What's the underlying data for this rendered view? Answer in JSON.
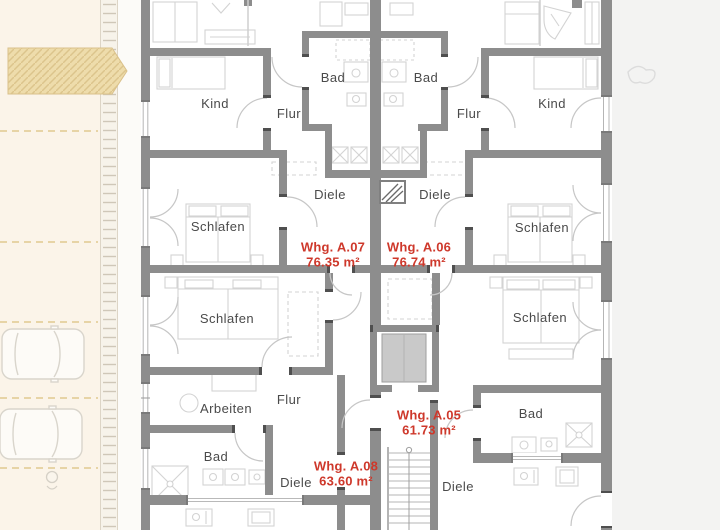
{
  "rooms": [
    {
      "id": "kind-left",
      "label": "Kind"
    },
    {
      "id": "flur-upper-left",
      "label": "Flur"
    },
    {
      "id": "bad-upper-left",
      "label": "Bad"
    },
    {
      "id": "bad-upper-right",
      "label": "Bad"
    },
    {
      "id": "flur-upper-right",
      "label": "Flur"
    },
    {
      "id": "kind-right",
      "label": "Kind"
    },
    {
      "id": "diele-upper-left",
      "label": "Diele"
    },
    {
      "id": "diele-upper-right",
      "label": "Diele"
    },
    {
      "id": "schlafen-upper-left",
      "label": "Schlafen"
    },
    {
      "id": "schlafen-upper-right",
      "label": "Schlafen"
    },
    {
      "id": "schlafen-lower-left",
      "label": "Schlafen"
    },
    {
      "id": "schlafen-lower-right",
      "label": "Schlafen"
    },
    {
      "id": "arbeiten",
      "label": "Arbeiten"
    },
    {
      "id": "flur-lower-left",
      "label": "Flur"
    },
    {
      "id": "bad-lower-left",
      "label": "Bad"
    },
    {
      "id": "bad-lower-right",
      "label": "Bad"
    },
    {
      "id": "diele-lower-left",
      "label": "Diele"
    },
    {
      "id": "diele-lower-right",
      "label": "Diele"
    }
  ],
  "apartments": [
    {
      "id": "whg-a07",
      "name": "Whg. A.07",
      "area": "76.35 m²"
    },
    {
      "id": "whg-a06",
      "name": "Whg. A.06",
      "area": "76.74 m²"
    },
    {
      "id": "whg-a05",
      "name": "Whg. A.05",
      "area": "61.73 m²"
    },
    {
      "id": "whg-a08",
      "name": "Whg. A.08",
      "area": "63.60 m²"
    }
  ],
  "colors": {
    "apartment_accent": "#ce382b",
    "room_label": "#4a4a4a",
    "wall": "#8d8d8d",
    "parking_background": "#fbf4e9",
    "driveway_hatch": "#eedcab",
    "site_background": "#f3f3f2"
  },
  "icons": {
    "cars": "car-icon",
    "plant": "plant-sketch-icon",
    "shaft": "shaft-hatch-icon",
    "stairs": "stairs-icon",
    "elevator": "elevator-icon"
  }
}
